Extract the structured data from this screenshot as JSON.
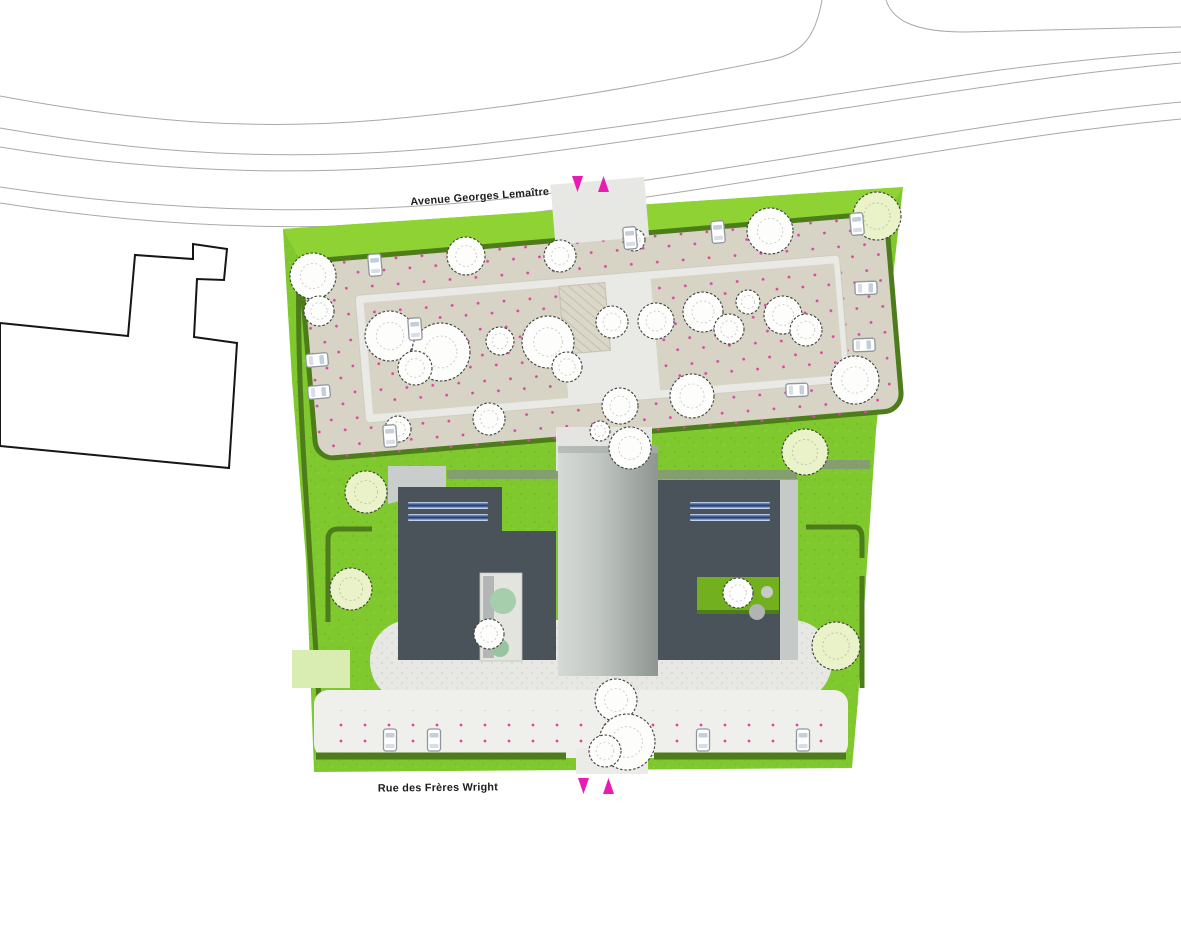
{
  "streets": {
    "avenue_top": "Avenue Georges Lemaître",
    "rue_bottom": "Rue des Frères Wright"
  },
  "access_arrows": {
    "color": "#e81cb4",
    "top": {
      "directions": [
        "down",
        "up"
      ]
    },
    "bottom": {
      "directions": [
        "down",
        "up"
      ]
    }
  },
  "palette": {
    "lawn_green": "#7fc82e",
    "lawn_green_light": "#8ed333",
    "hedge_green": "#4d7c1a",
    "parking_beige": "#d8d4c5",
    "parking_dot_magenta": "#d9469f",
    "island_gray": "#e9e9e5",
    "building_dark": "#4a525a",
    "core_gray": "#b9bfba",
    "canopy_gray": "#c9cdcb",
    "path_concrete": "#e7e8e4",
    "street_strip": "#efefec",
    "skylight_blue": "#1e3a70",
    "tree_white": "#fdfdfb",
    "tree_light_green": "#e9f2c8",
    "road_line_gray": "#a8a8a8",
    "context_outline": "#151515"
  },
  "site": {
    "buildings": [
      {
        "name": "west-building",
        "roof_color": "#4a525a",
        "skylight_strips": 2
      },
      {
        "name": "east-building",
        "roof_color": "#4a525a",
        "skylight_strips": 2
      },
      {
        "name": "central-core",
        "roof_color": "gray-gradient"
      }
    ],
    "trees": [
      {
        "x": 313,
        "y": 276,
        "r": 23,
        "t": "w"
      },
      {
        "x": 319,
        "y": 311,
        "r": 15,
        "t": "w"
      },
      {
        "x": 466,
        "y": 256,
        "r": 19,
        "t": "w"
      },
      {
        "x": 560,
        "y": 256,
        "r": 16,
        "t": "w"
      },
      {
        "x": 634,
        "y": 240,
        "r": 11,
        "t": "w"
      },
      {
        "x": 770,
        "y": 231,
        "r": 23,
        "t": "w"
      },
      {
        "x": 877,
        "y": 216,
        "r": 24,
        "t": "g"
      },
      {
        "x": 390,
        "y": 336,
        "r": 25,
        "t": "w"
      },
      {
        "x": 441,
        "y": 352,
        "r": 29,
        "t": "w"
      },
      {
        "x": 415,
        "y": 368,
        "r": 17,
        "t": "w"
      },
      {
        "x": 500,
        "y": 341,
        "r": 14,
        "t": "w"
      },
      {
        "x": 548,
        "y": 342,
        "r": 26,
        "t": "w"
      },
      {
        "x": 567,
        "y": 367,
        "r": 15,
        "t": "w"
      },
      {
        "x": 612,
        "y": 322,
        "r": 16,
        "t": "w"
      },
      {
        "x": 656,
        "y": 321,
        "r": 18,
        "t": "w"
      },
      {
        "x": 703,
        "y": 312,
        "r": 20,
        "t": "w"
      },
      {
        "x": 729,
        "y": 329,
        "r": 15,
        "t": "w"
      },
      {
        "x": 748,
        "y": 302,
        "r": 12,
        "t": "w"
      },
      {
        "x": 783,
        "y": 315,
        "r": 19,
        "t": "w"
      },
      {
        "x": 806,
        "y": 330,
        "r": 16,
        "t": "w"
      },
      {
        "x": 398,
        "y": 429,
        "r": 13,
        "t": "w"
      },
      {
        "x": 489,
        "y": 419,
        "r": 16,
        "t": "w"
      },
      {
        "x": 620,
        "y": 406,
        "r": 18,
        "t": "w"
      },
      {
        "x": 692,
        "y": 396,
        "r": 22,
        "t": "w"
      },
      {
        "x": 855,
        "y": 380,
        "r": 24,
        "t": "w"
      },
      {
        "x": 805,
        "y": 452,
        "r": 23,
        "t": "g"
      },
      {
        "x": 366,
        "y": 492,
        "r": 21,
        "t": "g"
      },
      {
        "x": 351,
        "y": 589,
        "r": 21,
        "t": "g"
      },
      {
        "x": 836,
        "y": 646,
        "r": 24,
        "t": "g"
      },
      {
        "x": 630,
        "y": 448,
        "r": 21,
        "t": "w"
      },
      {
        "x": 600,
        "y": 431,
        "r": 10,
        "t": "w"
      },
      {
        "x": 489,
        "y": 634,
        "r": 15,
        "t": "w"
      },
      {
        "x": 738,
        "y": 593,
        "r": 15,
        "t": "w"
      },
      {
        "x": 616,
        "y": 700,
        "r": 21,
        "t": "w"
      },
      {
        "x": 627,
        "y": 742,
        "r": 28,
        "t": "w"
      },
      {
        "x": 605,
        "y": 751,
        "r": 16,
        "t": "w"
      }
    ],
    "cars": [
      [
        375,
        265,
        -5
      ],
      [
        630,
        238,
        -5
      ],
      [
        718,
        232,
        -5
      ],
      [
        857,
        224,
        -5
      ],
      [
        317,
        360,
        85
      ],
      [
        319,
        392,
        85
      ],
      [
        415,
        329,
        -4
      ],
      [
        866,
        288,
        88
      ],
      [
        864,
        345,
        88
      ],
      [
        390,
        436,
        -4
      ],
      [
        797,
        390,
        88
      ],
      [
        390,
        740,
        0
      ],
      [
        434,
        740,
        0
      ],
      [
        703,
        740,
        0
      ],
      [
        803,
        740,
        0
      ]
    ]
  }
}
